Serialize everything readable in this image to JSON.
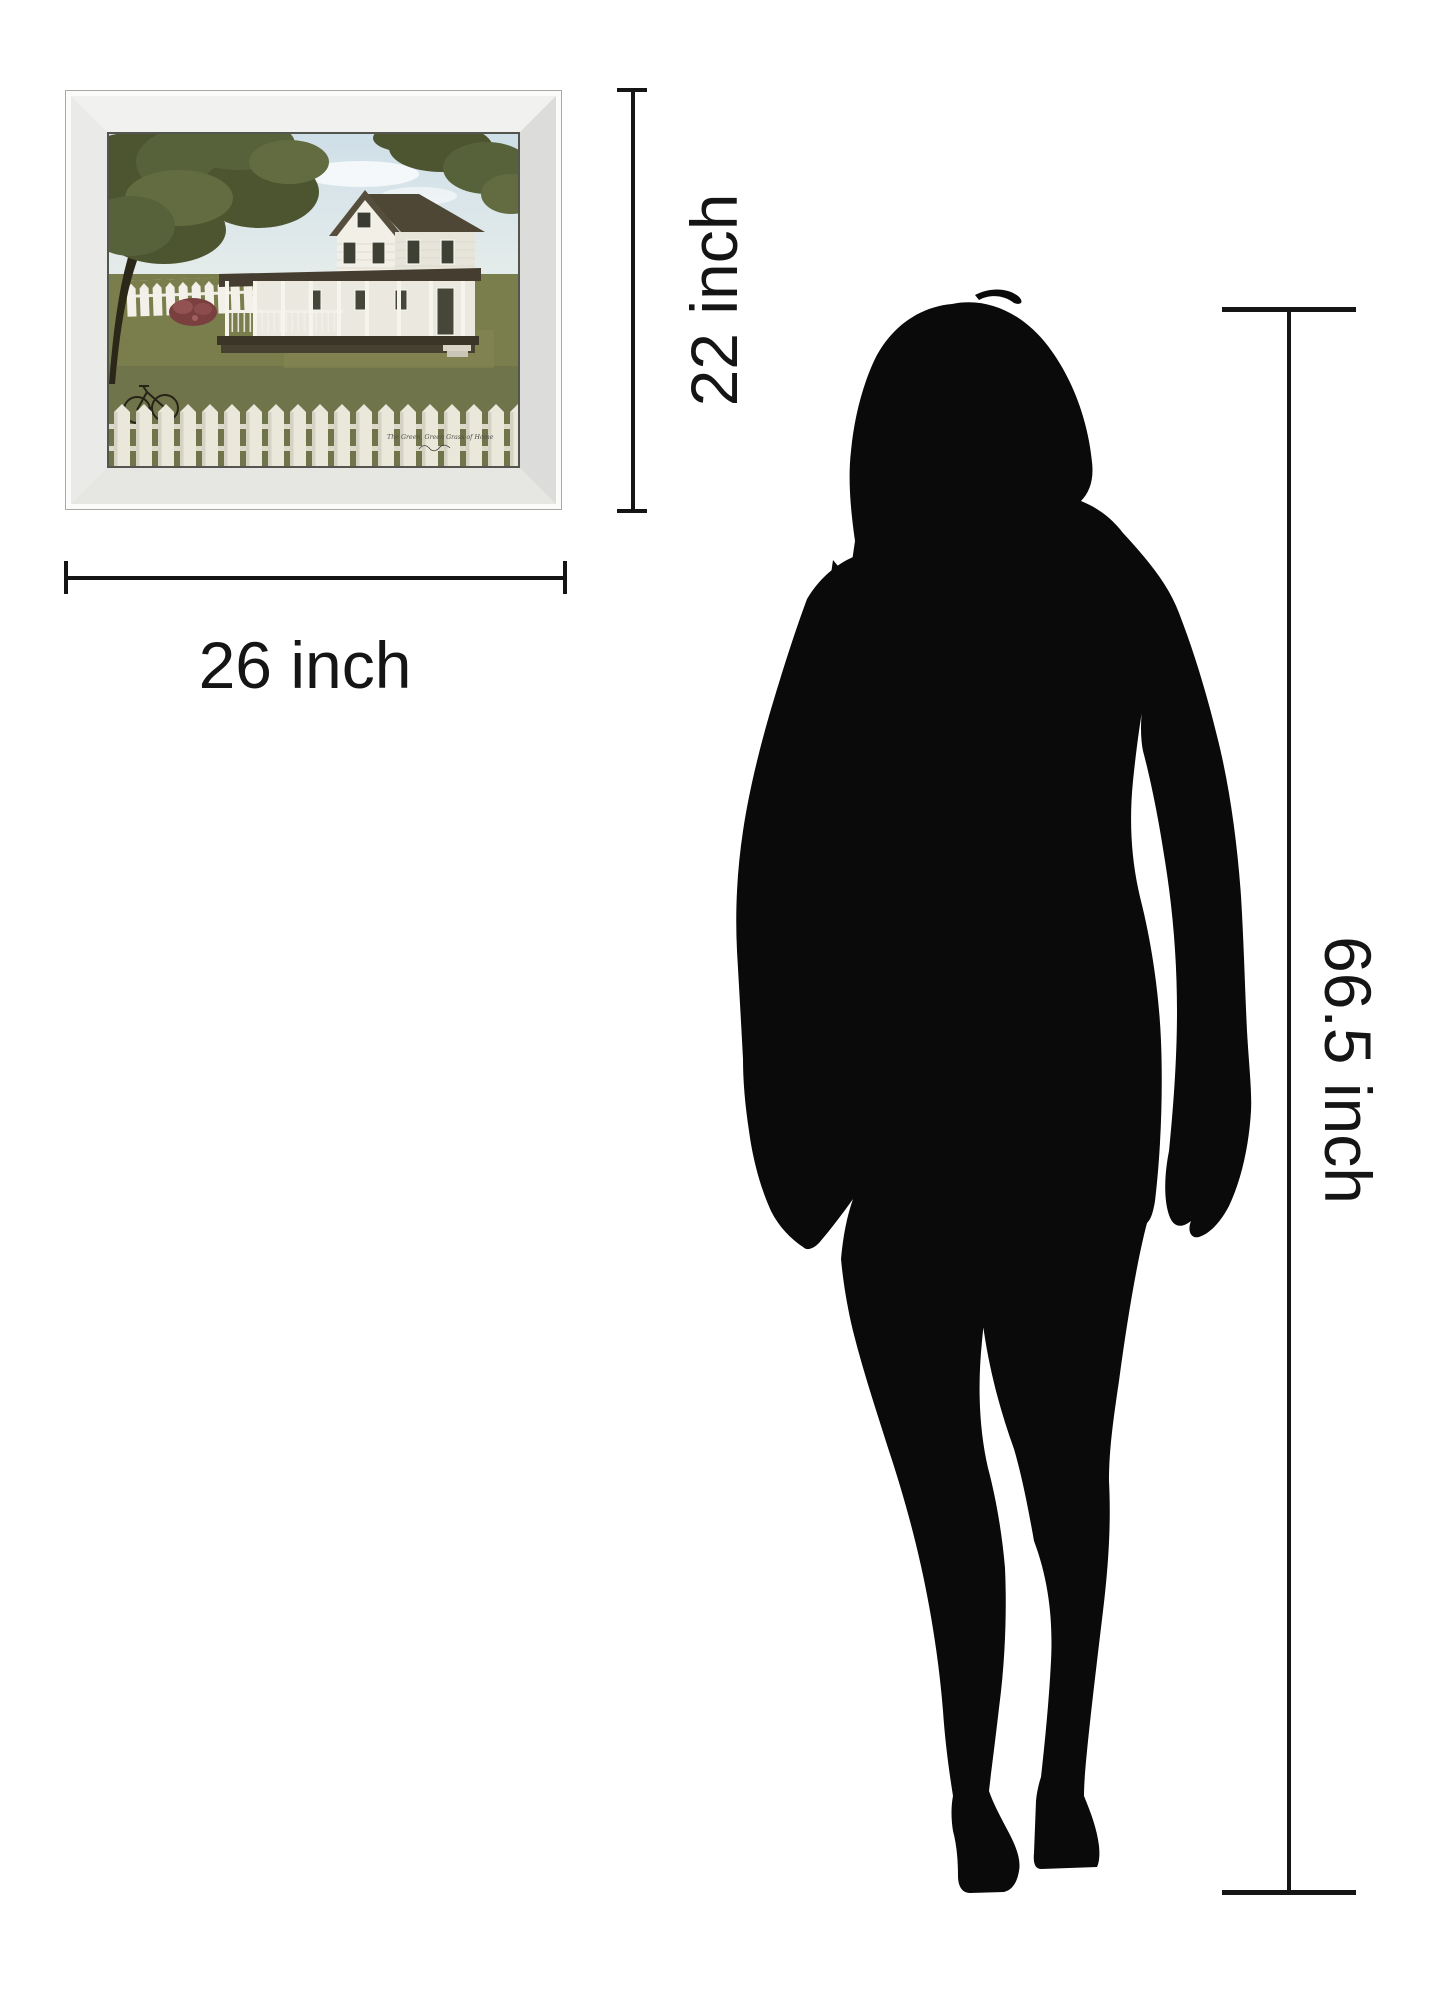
{
  "page": {
    "background_color": "#ffffff"
  },
  "artwork": {
    "caption": "The Green, Green Grass of Home",
    "width_label": "26 inch",
    "height_label": "22 inch",
    "frame_finish_color": "#ececea",
    "scene_colors": {
      "sky": "#d3e2ea",
      "grass": "#7a7d4c",
      "foliage": "#55603a",
      "roof": "#4f4736",
      "house": "#f1efe6",
      "fence": "#eae8db",
      "bush": "#7a4040"
    }
  },
  "person": {
    "height_label": "66.5 inch",
    "silhouette_color": "#0a0a0a"
  },
  "dimension_lines": {
    "color": "#151515"
  }
}
